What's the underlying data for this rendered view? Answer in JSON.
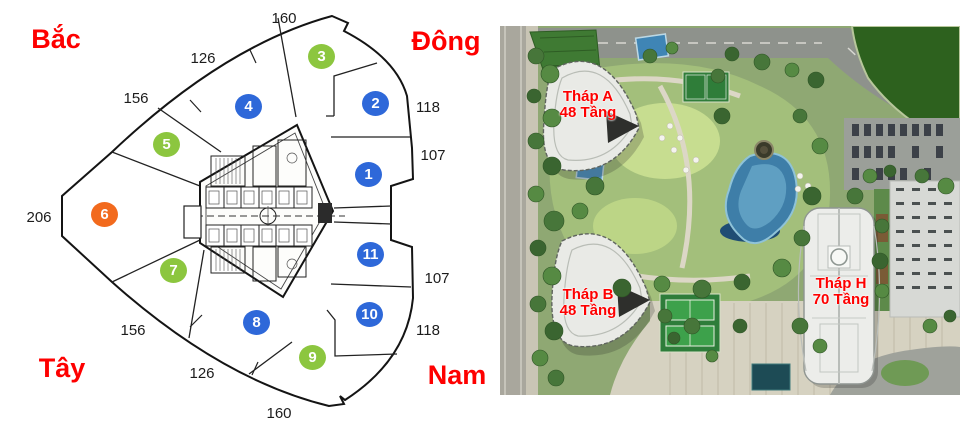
{
  "floor_plan": {
    "compass": {
      "north": "Bắc",
      "east": "Đông",
      "west": "Tây",
      "south": "Nam",
      "color": "#fe0000"
    },
    "units": [
      {
        "number": "1",
        "color": "#2e68d9"
      },
      {
        "number": "2",
        "color": "#2e68d9"
      },
      {
        "number": "3",
        "color": "#8cc63f"
      },
      {
        "number": "4",
        "color": "#2e68d9"
      },
      {
        "number": "5",
        "color": "#8cc63f"
      },
      {
        "number": "6",
        "color": "#f26a1d"
      },
      {
        "number": "7",
        "color": "#8cc63f"
      },
      {
        "number": "8",
        "color": "#2e68d9"
      },
      {
        "number": "9",
        "color": "#8cc63f"
      },
      {
        "number": "10",
        "color": "#2e68d9"
      },
      {
        "number": "11",
        "color": "#2e68d9"
      }
    ],
    "unit_colors": {
      "blue": "#2e68d9",
      "green": "#8cc63f",
      "orange": "#f26a1d"
    },
    "dimensions": [
      {
        "edge": "top",
        "value": "160"
      },
      {
        "edge": "top-left",
        "value": "126"
      },
      {
        "edge": "upper-left",
        "value": "156"
      },
      {
        "edge": "left",
        "value": "206"
      },
      {
        "edge": "lower-left",
        "value": "156"
      },
      {
        "edge": "bottom-left",
        "value": "126"
      },
      {
        "edge": "bottom",
        "value": "160"
      },
      {
        "edge": "right-top",
        "value": "118"
      },
      {
        "edge": "right-upper",
        "value": "107"
      },
      {
        "edge": "right-lower",
        "value": "107"
      },
      {
        "edge": "right-bottom",
        "value": "118"
      }
    ]
  },
  "site_plan": {
    "label_color": "#fe0000",
    "towers": [
      {
        "name": "Tháp A",
        "floors": "48 Tầng"
      },
      {
        "name": "Tháp B",
        "floors": "48 Tầng"
      },
      {
        "name": "Tháp H",
        "floors": "70 Tầng"
      }
    ]
  }
}
